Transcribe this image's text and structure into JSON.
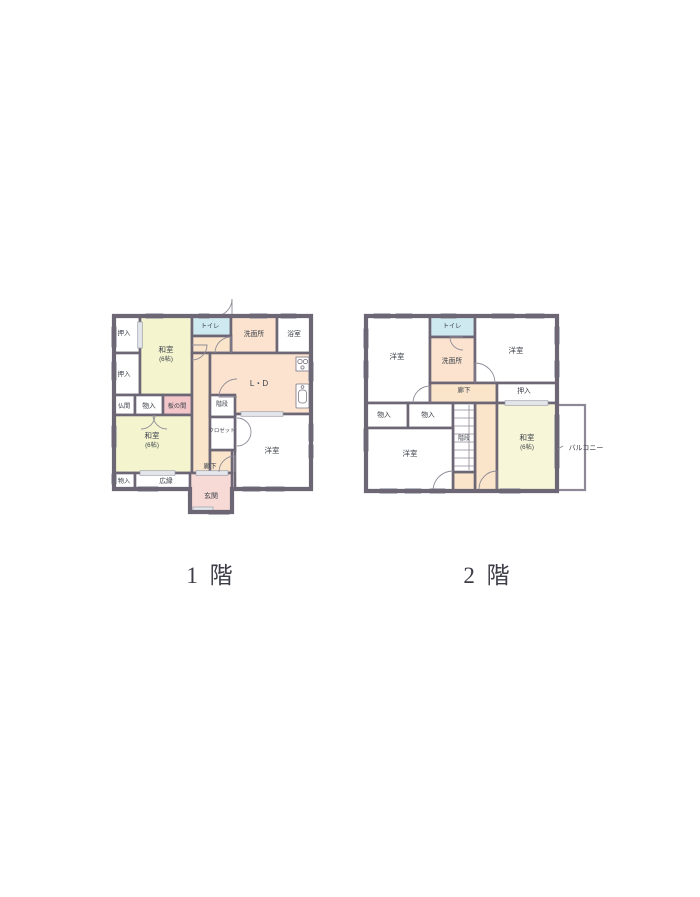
{
  "document": {
    "type": "floor-plan",
    "background": "#ffffff"
  },
  "colors": {
    "wall": "#6d6674",
    "tatami_room": "#f4f5cf",
    "living_peach": "#fbe3cf",
    "hallway_cream": "#fae5cb",
    "toilet_blue": "#cfe9f0",
    "itanoma_pink": "#f3c7ca",
    "genkan_pink": "#f7dad5",
    "white_room": "#ffffff",
    "window_mark": "#e4e6eb",
    "label_text": "#3c4049"
  },
  "floor1": {
    "caption": "1 階",
    "labels": {
      "oshiire": "押入",
      "washitsu": "和室",
      "washitsu_size": "(6帖)",
      "butsuma": "仏間",
      "monoiri": "物入",
      "itanoma": "板の間",
      "hiroen": "広縁",
      "toilet": "トイレ",
      "senmenjo": "洗面所",
      "yokushitsu": "浴室",
      "ld": "L・D",
      "kaidan": "階段",
      "closet": "クロゼット",
      "yoshitsu": "洋室",
      "rouka": "廊下",
      "genkan": "玄関"
    }
  },
  "floor2": {
    "caption": "2 階",
    "labels": {
      "yoshitsu": "洋室",
      "toilet": "トイレ",
      "senmenjo": "洗面所",
      "rouka": "廊下",
      "oshiire": "押入",
      "monoiri": "物入",
      "kaidan": "階段",
      "washitsu": "和室",
      "washitsu_size": "(6帖)",
      "balcony": "バルコニー"
    }
  }
}
